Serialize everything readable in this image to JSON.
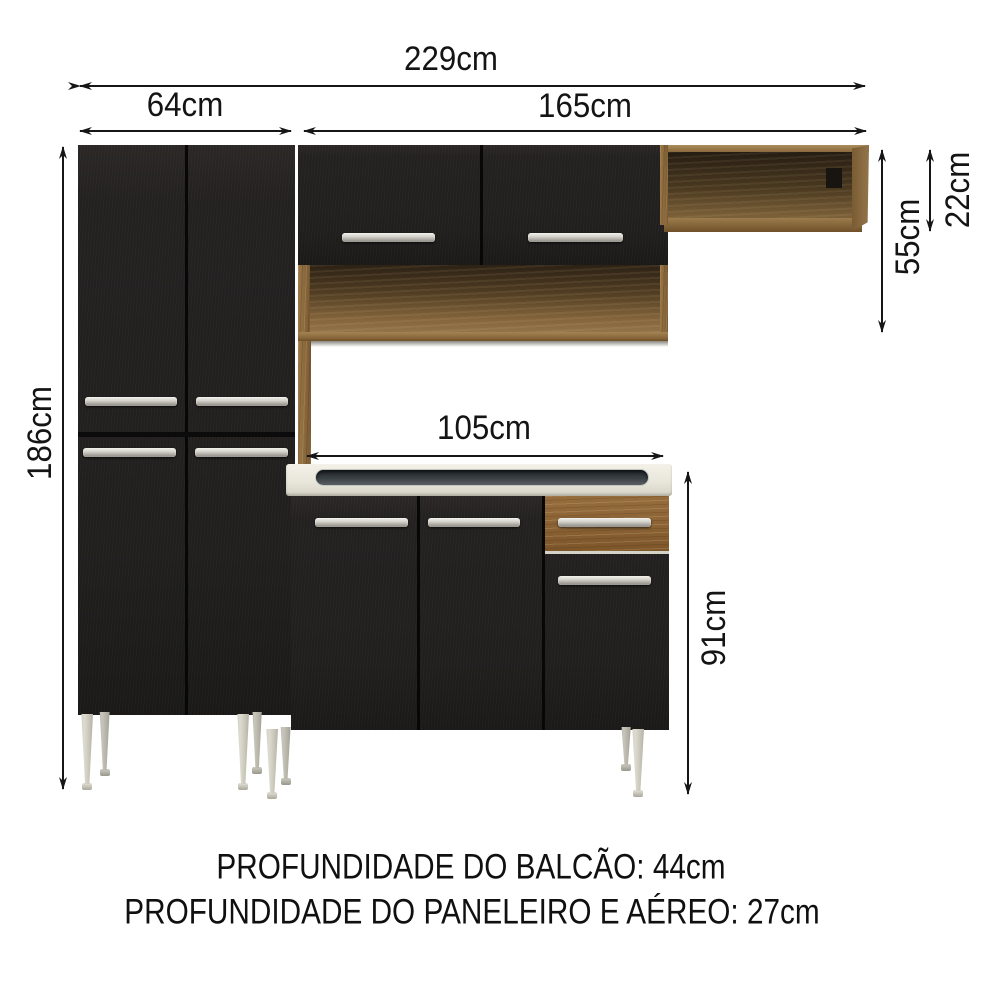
{
  "dimensions": {
    "total_width": "229cm",
    "paneleiro_width": "64cm",
    "upper_section_width": "165cm",
    "paneleiro_height": "186cm",
    "aereo_height": "55cm",
    "wall_shelf_height": "22cm",
    "balcao_width": "105cm",
    "balcao_height": "91cm"
  },
  "footer": {
    "line1": "PROFUNDIDADE DO BALCÃO: 44cm",
    "line2": "PROFUNDIDADE DO PANELEIRO E AÉREO: 27cm"
  },
  "colors": {
    "door_black": "#232120",
    "wood_brown": "#8a6234",
    "wood_light": "#9c7c4c",
    "countertop_cream": "#e9e7db",
    "sink_gray": "#3c4347",
    "handle_silver": "#c9c8c0",
    "leg_gray": "#c9c7ba",
    "dimension_ink": "#161616",
    "background": "#ffffff"
  }
}
